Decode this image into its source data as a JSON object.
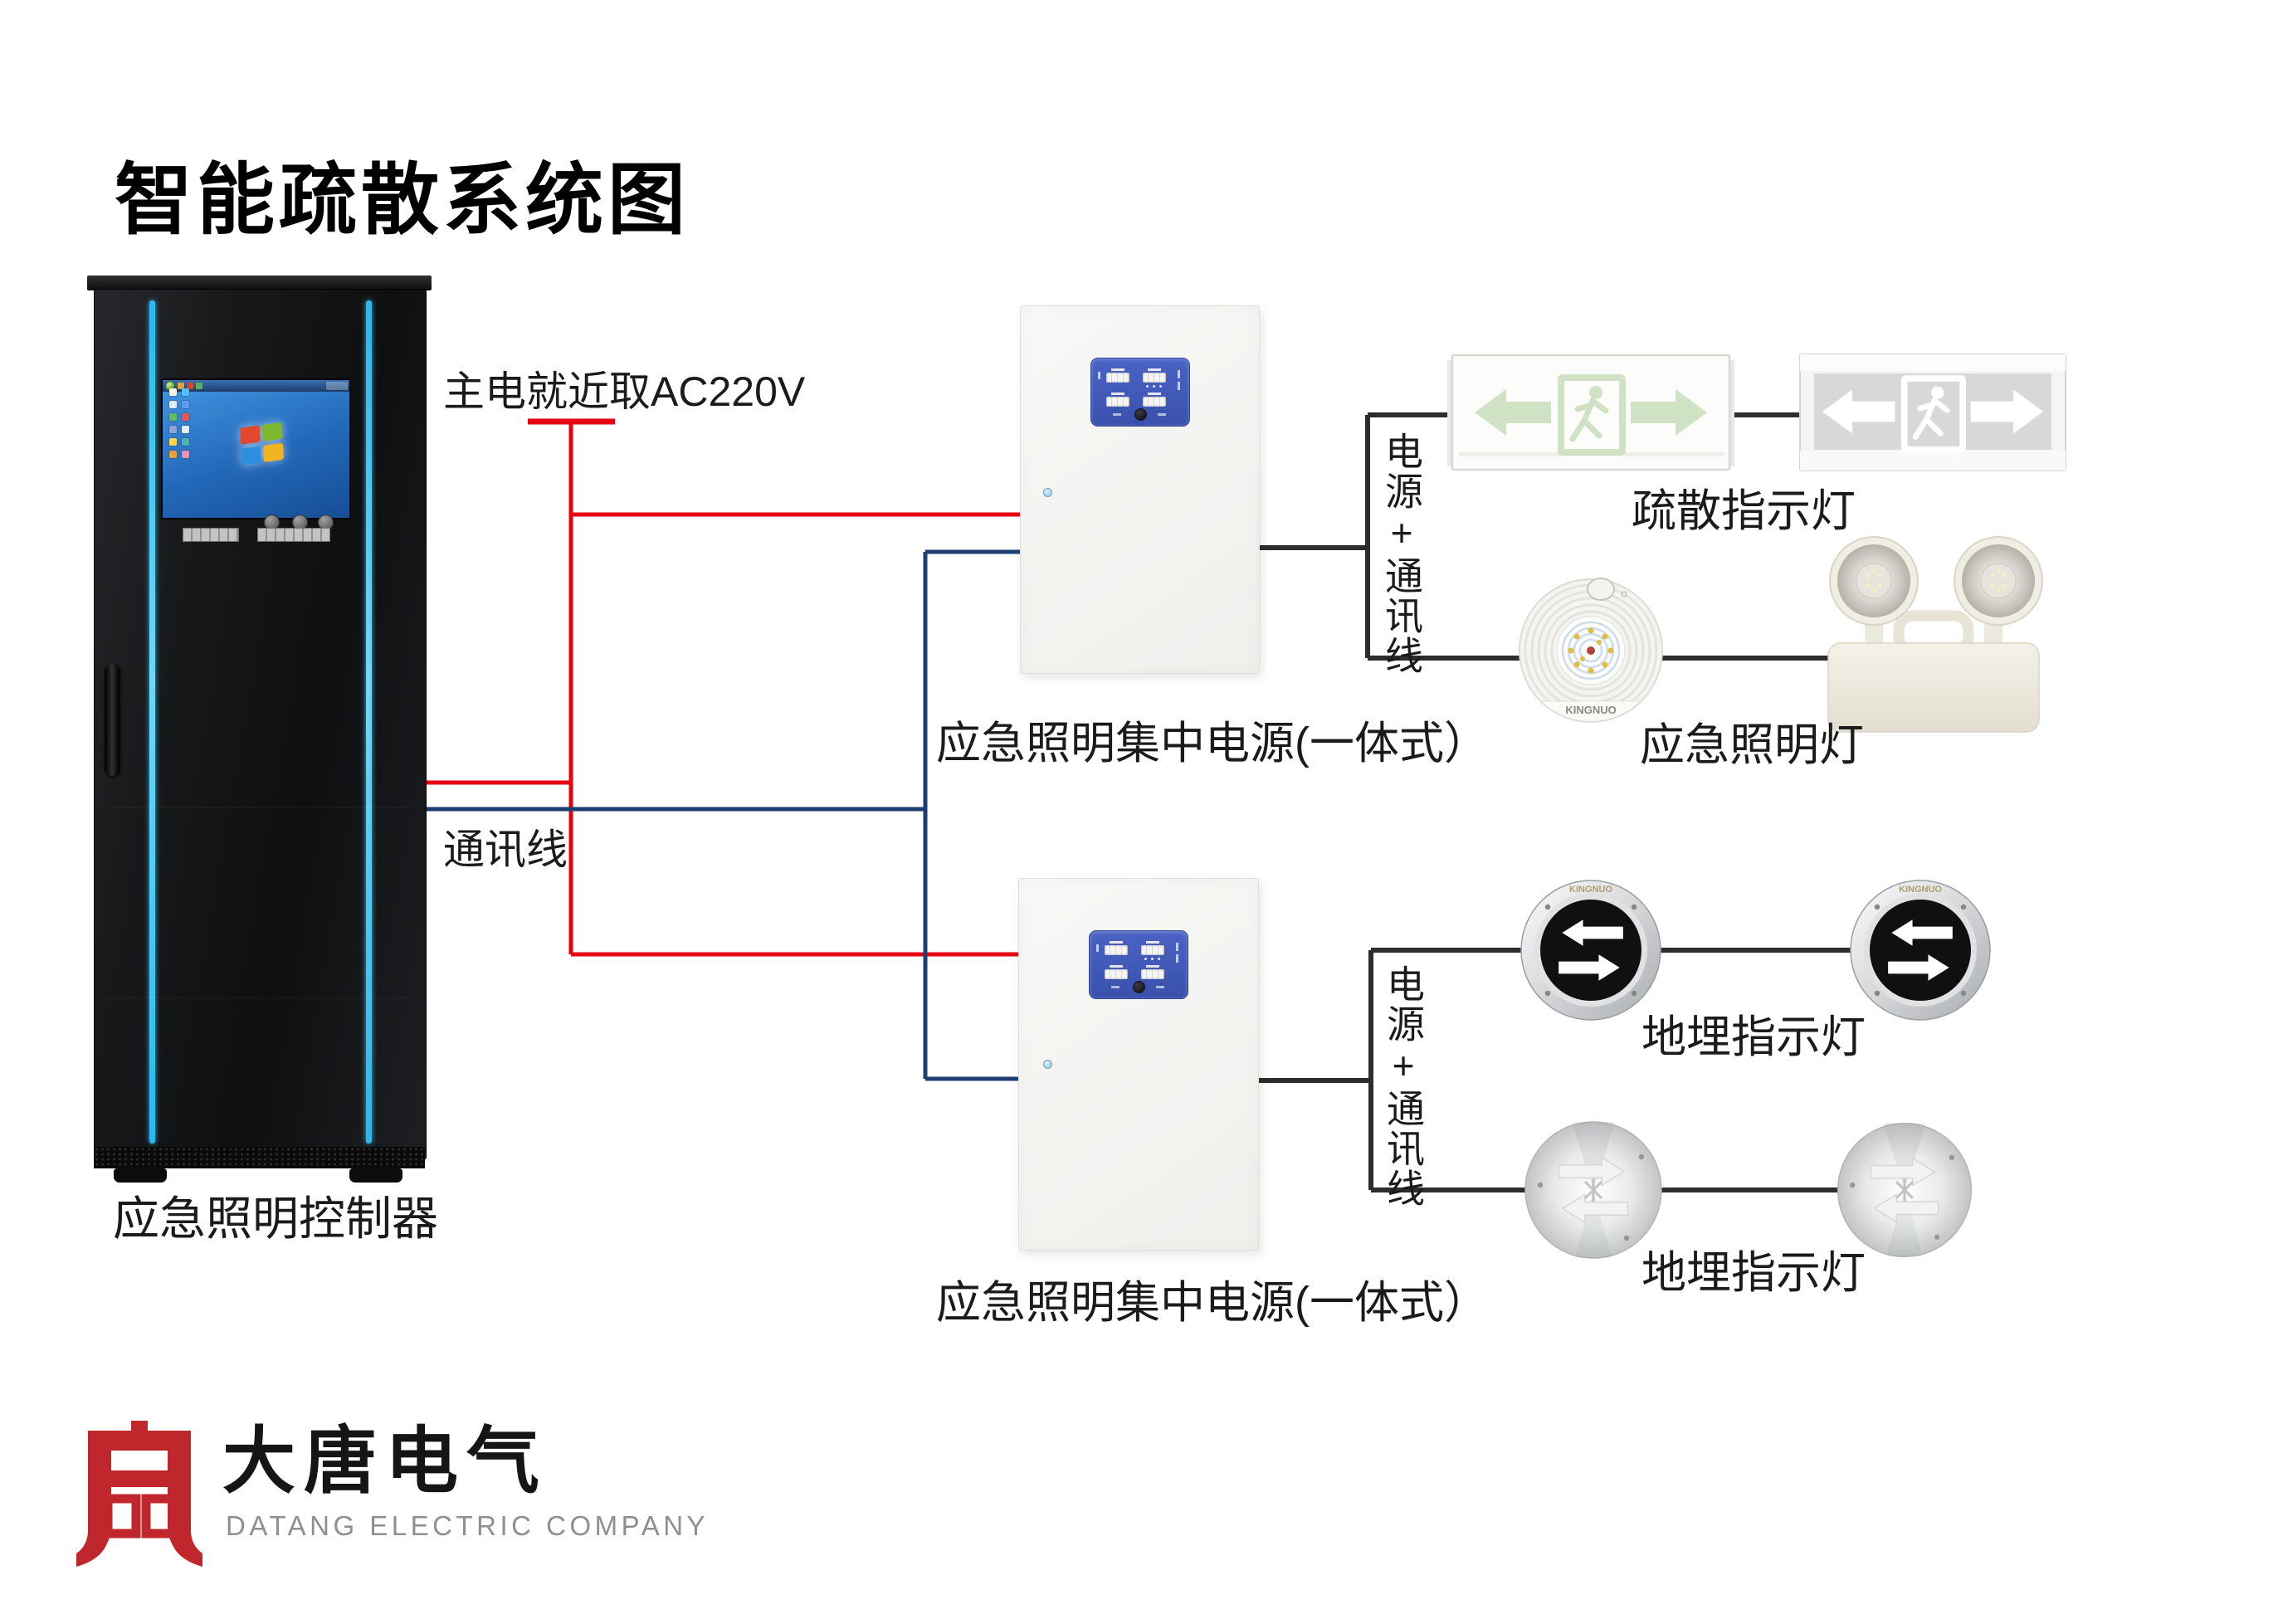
{
  "title": "智能疏散系统图",
  "cabinet": {
    "label": "应急照明控制器"
  },
  "wires": {
    "main_power_label": "主电就近取AC220V",
    "comm_label": "通讯线",
    "bus1_label": "电源+通讯线",
    "bus2_label": "电源+通讯线"
  },
  "power_units": {
    "unit1_label": "应急照明集中电源(一体式）",
    "unit2_label": "应急照明集中电源(一体式）"
  },
  "devices": {
    "exit_sign_label": "疏散指示灯",
    "emergency_light_label": "应急照明灯",
    "buried_light_label_top": "地埋指示灯",
    "buried_light_label_bottom": "地埋指示灯",
    "lamp_brand": "KINGNUO"
  },
  "logo": {
    "cn": "大唐电气",
    "en": "DATANG ELECTRIC COMPANY"
  },
  "colors": {
    "power_wire": "#e60012",
    "comm_wire": "#1c3e70",
    "bus_wire": "#2d2d2d",
    "panel_blue": "#3f58b7",
    "cabinet_accent": "#45c8f5",
    "logo_red": "#c0272d"
  }
}
